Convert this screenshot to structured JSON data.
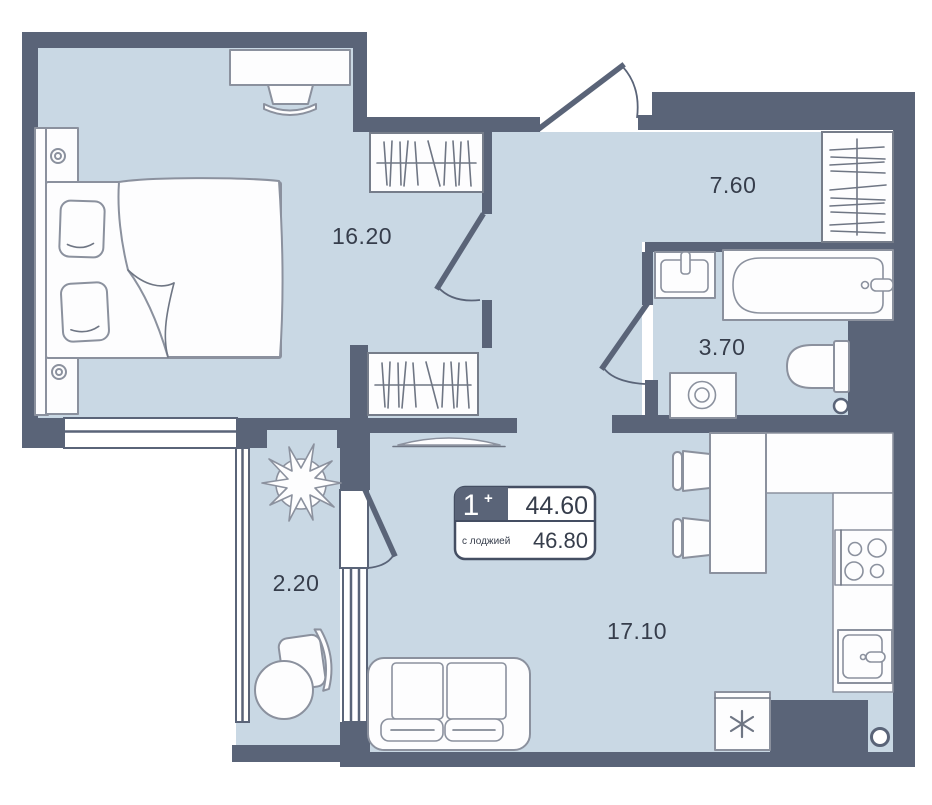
{
  "plan": {
    "title": "apartment-floor-plan",
    "badge": {
      "rooms": "1",
      "plus": "+",
      "area_total": "44.60",
      "with_loggia_label": "с лоджией",
      "area_with_loggia": "46.80"
    },
    "rooms": [
      {
        "id": "bedroom",
        "area": "16.20"
      },
      {
        "id": "hallway",
        "area": "7.60"
      },
      {
        "id": "bathroom",
        "area": "3.70"
      },
      {
        "id": "loggia",
        "area": "2.20"
      },
      {
        "id": "kitchen-living-room",
        "area": "17.10"
      }
    ],
    "colors": {
      "wall": "#5a6478",
      "floor": "#c9d8e4",
      "furniture_fill": "#fdfdfe",
      "furniture_stroke": "#8b919e",
      "text": "#363d4b",
      "badge_border": "#444e62"
    }
  }
}
